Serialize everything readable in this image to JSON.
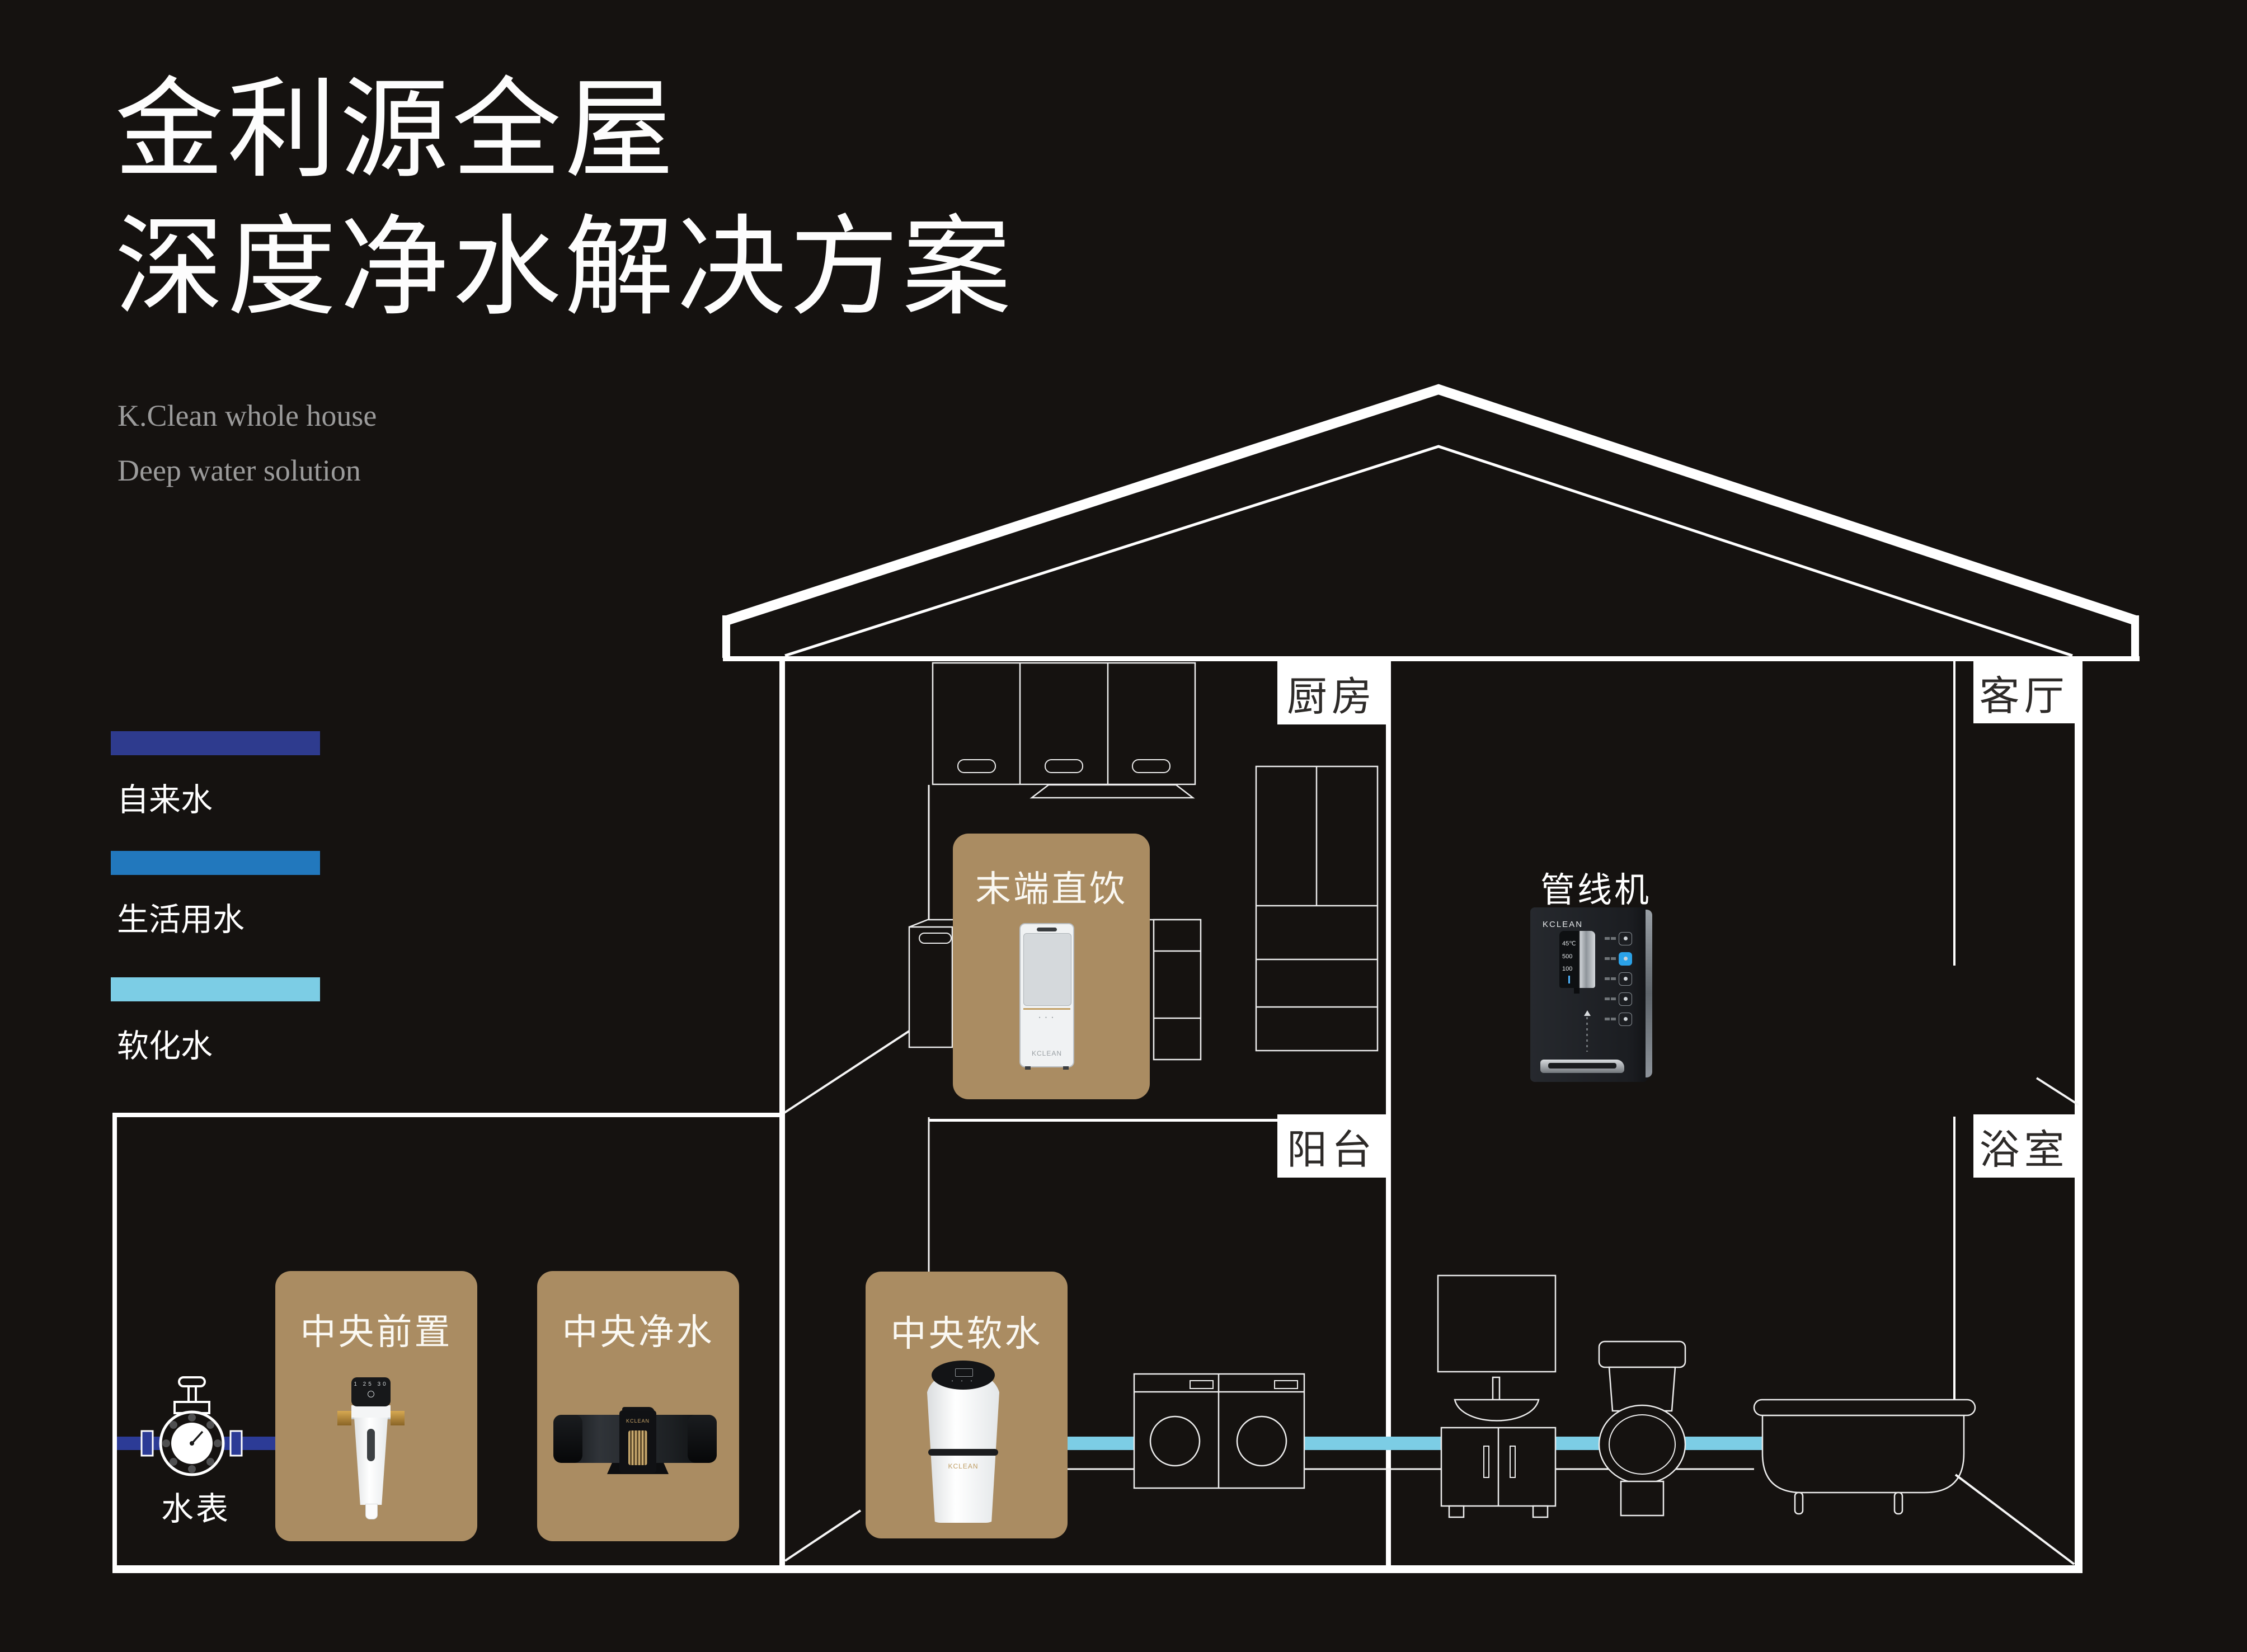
{
  "title": {
    "line1": "金利源全屋",
    "line2": "深度净水解决方案"
  },
  "subtitle": {
    "line1": "K.Clean whole house",
    "line2": "Deep water solution"
  },
  "legend": {
    "items": [
      {
        "label": "自来水",
        "color": "#2e3b8e"
      },
      {
        "label": "生活用水",
        "color": "#2278bd"
      },
      {
        "label": "软化水",
        "color": "#7ccde5"
      }
    ]
  },
  "rooms": {
    "kitchen": "厨房",
    "living": "客厅",
    "balcony": "阳台",
    "bathroom": "浴室"
  },
  "stations": {
    "terminal": "末端直饮",
    "pipeline": "管线机",
    "prefilter": "中央前置",
    "purifier": "中央净水",
    "softener": "中央软水",
    "meter": "水表"
  },
  "brand": "KCLEAN",
  "devices": {
    "pipeline_display": {
      "temp": "45℃",
      "flow": "500",
      "tds": "100"
    },
    "prefilter_display": "1 25 30"
  },
  "colors": {
    "background": "#151210",
    "line": "#ffffff",
    "gold": "#aa8c62",
    "tap_pipe": "#2c3b96",
    "soft_pipe": "#7ccde5",
    "label_text": "#2d2a28"
  }
}
